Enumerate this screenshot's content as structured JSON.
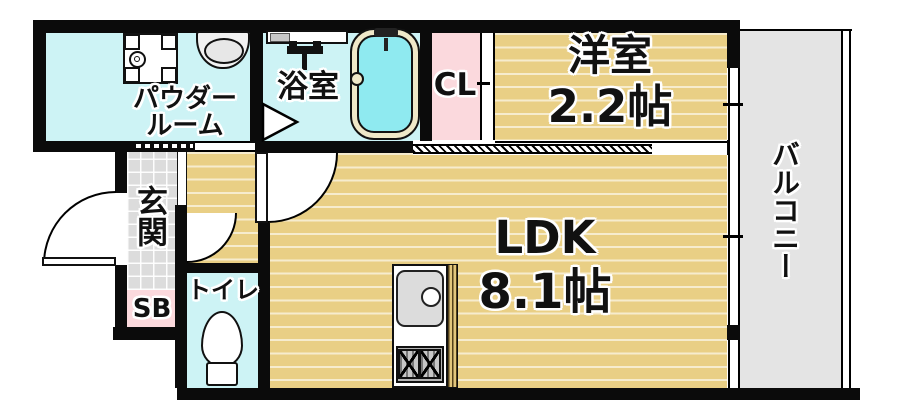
{
  "floorplan": {
    "labels": {
      "powder_line1": "パウダー",
      "powder_line2": "ルーム",
      "bath": "浴室",
      "closet": "CL",
      "western_name": "洋室",
      "western_size": "2.2帖",
      "balcony": "バルコニー",
      "entrance": "玄関",
      "shoebox": "SB",
      "toilet": "トイレ",
      "ldk_name": "LDK",
      "ldk_size": "8.1帖"
    },
    "colors": {
      "wall": "#0b0b0b",
      "wet_room_cyan": "#cdf3f5",
      "closet_pink": "#fbd9dd",
      "wood_floor_tan": "#e9cf85",
      "entrance_tile_gray": "#dcdcdc",
      "balcony_gray": "#e4e4e4",
      "tub_water_cyan": "#8feaf0",
      "tub_rim_cream": "#efe8c8"
    }
  }
}
